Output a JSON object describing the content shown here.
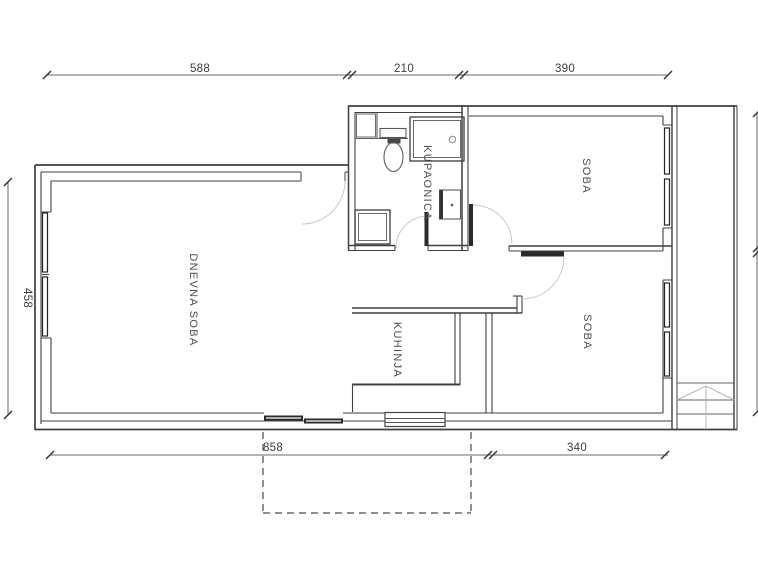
{
  "rooms": {
    "living": "DNEVNA SOBA",
    "bathroom": "KUPAONICA",
    "kitchen": "KUHINJA",
    "bedroom_top": "SOBA",
    "bedroom_bottom": "SOBA"
  },
  "dimensions": {
    "top_left": "588",
    "top_middle": "210",
    "top_right": "390",
    "left": "458",
    "bottom_left": "858",
    "bottom_right": "340"
  },
  "colors": {
    "wall": "#3f3f3f",
    "fixture": "#5a5a5a",
    "swing_arc": "#c9c9c9",
    "dim_line": "#6a6a6a",
    "label": "#4d4d4d",
    "door_leaf": "#2a2a2a"
  }
}
